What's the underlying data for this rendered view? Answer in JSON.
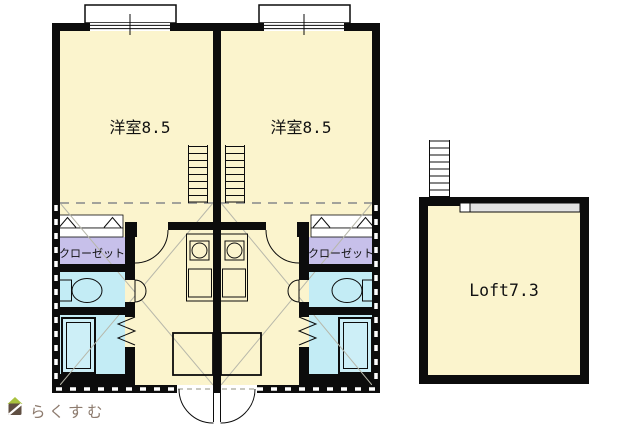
{
  "floorplan": {
    "units": [
      {
        "room_label": "洋室8.5",
        "closet_label": "クローゼット"
      },
      {
        "room_label": "洋室8.5",
        "closet_label": "クローゼット"
      }
    ],
    "loft_label": "Loft7.3",
    "watermark": "らくすむ",
    "colors": {
      "floor": "#fbf4cd",
      "closet": "#c7c0ea",
      "wet_area": "#c3ecf5",
      "wall": "#0c0c0c",
      "diagonal_lines": "#b7b7aa",
      "loft_strip": "#e4e4e4",
      "watermark_text": "#8d7b6e",
      "watermark_roof": "#a9c23f",
      "watermark_house": "#604f42"
    }
  }
}
